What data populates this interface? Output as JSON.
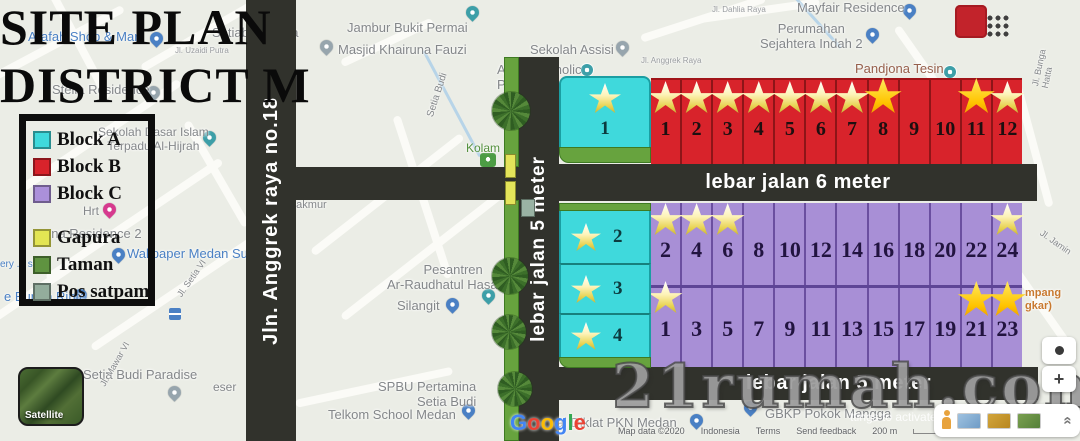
{
  "title": {
    "line1": "SITE PLAN",
    "line2": "DISTRICT M"
  },
  "legend": {
    "items": [
      {
        "label": "Block A",
        "color": "#3fd9dc"
      },
      {
        "label": "Block B",
        "color": "#d8232b"
      },
      {
        "label": "Block C",
        "color": "#ab90da"
      },
      {
        "label": "Gapura",
        "color": "#e3e553"
      },
      {
        "label": "Taman",
        "color": "#5f9340"
      },
      {
        "label": "Pos satpam",
        "color": "#93ad9c"
      }
    ]
  },
  "roads": {
    "street": "Jln. Anggrek raya no.18",
    "entry": "lebar jalan 5 meter",
    "top": "lebar jalan 6 meter",
    "bottom": "lebar jalan 5 meter"
  },
  "site": {
    "block_a": [
      {
        "n": "1",
        "star": "pale"
      },
      {
        "n": "2",
        "star": "pale"
      },
      {
        "n": "3",
        "star": "pale"
      },
      {
        "n": "4",
        "star": "pale"
      }
    ],
    "block_b": [
      {
        "n": "1",
        "star": "pale"
      },
      {
        "n": "2",
        "star": "pale"
      },
      {
        "n": "3",
        "star": "pale"
      },
      {
        "n": "4",
        "star": "pale"
      },
      {
        "n": "5",
        "star": "pale"
      },
      {
        "n": "6",
        "star": "pale"
      },
      {
        "n": "7",
        "star": "pale"
      },
      {
        "n": "8",
        "star": "bright"
      },
      {
        "n": "9"
      },
      {
        "n": "10"
      },
      {
        "n": "11",
        "star": "bright"
      },
      {
        "n": "12",
        "star": "pale"
      }
    ],
    "block_c_even": [
      {
        "n": "2",
        "star": "pale"
      },
      {
        "n": "4",
        "star": "pale"
      },
      {
        "n": "6",
        "star": "pale"
      },
      {
        "n": "8"
      },
      {
        "n": "10"
      },
      {
        "n": "12"
      },
      {
        "n": "14"
      },
      {
        "n": "16"
      },
      {
        "n": "18"
      },
      {
        "n": "20"
      },
      {
        "n": "22"
      },
      {
        "n": "24",
        "star": "pale"
      }
    ],
    "block_c_odd": [
      {
        "n": "1",
        "star": "pale"
      },
      {
        "n": "3"
      },
      {
        "n": "5"
      },
      {
        "n": "7"
      },
      {
        "n": "9"
      },
      {
        "n": "11"
      },
      {
        "n": "13"
      },
      {
        "n": "15"
      },
      {
        "n": "17"
      },
      {
        "n": "19"
      },
      {
        "n": "21",
        "star": "bright"
      },
      {
        "n": "23",
        "star": "bright"
      }
    ]
  },
  "map": {
    "labels": [
      "Jambur Bukit Permai",
      "Setiabudi Vista",
      "Arafah Shop & Mart",
      "Masjid Khairuna Fauzi",
      "Sekolah Assisi",
      "Assisi Catholic\nPr",
      "Jl. Anggrek Raya",
      "Jl. Dahlia Raya",
      "Mayfair Residence",
      "Perumahan\nSejahtera Indah 2",
      "Pandjona Tesin",
      "Stella Residence",
      "Sekolah Dasar Islam\nTerpadu Al-Hijrah",
      "Jl. Uzaidi Putra",
      "Hrt",
      "ena Residence 2",
      "Wallpaper Medan Su",
      "ery ... shop",
      "e Bunga Rinte",
      "Setia Budi Paradise",
      "eser",
      "SPBU Pertamina\nSetia Budi",
      "Telkom School Medan",
      "Balai Diklat PKN Medan",
      "GBKP Pokok Mangga",
      "Kolam",
      "Pesantren\nAr-Raudhatul Hasanah",
      "Silangit",
      "makmur",
      "mpang\ngkar)",
      "Setia Budi",
      "Jl. Setia VI",
      "Jl. Mawar VI",
      "Jl. Bunga Hatta",
      "Jl. Jamin",
      "ttings to activate Wi"
    ],
    "pins": [
      {
        "icon": "pin",
        "tone": "teal"
      },
      {
        "icon": "pin",
        "tone": "gray"
      },
      {
        "icon": "pin",
        "tone": "gray"
      },
      {
        "icon": "dot",
        "tone": "teal"
      },
      {
        "icon": "pin",
        "tone": "blue"
      },
      {
        "icon": "pin",
        "tone": "blue"
      },
      {
        "icon": "dot",
        "tone": "teal"
      },
      {
        "icon": "pin",
        "tone": "gray"
      },
      {
        "icon": "pin",
        "tone": "teal"
      },
      {
        "icon": "pin",
        "tone": "blue"
      },
      {
        "icon": "pin",
        "tone": "pink"
      },
      {
        "icon": "pin",
        "tone": "blue"
      },
      {
        "icon": "pin",
        "tone": "blue"
      },
      {
        "icon": "pin",
        "tone": "gray"
      },
      {
        "icon": "pin",
        "tone": "blue"
      },
      {
        "icon": "pin",
        "tone": "blue"
      },
      {
        "icon": "pin",
        "tone": "blue"
      },
      {
        "icon": "pin",
        "tone": "teal"
      },
      {
        "icon": "pin",
        "tone": "blue"
      },
      {
        "icon": "park",
        "tone": "green"
      },
      {
        "icon": "transit",
        "tone": "blue"
      }
    ]
  },
  "colors": {
    "tones": {
      "blue": "#4a80c4",
      "teal": "#3d9fa8",
      "gray": "#97a5ad",
      "pink": "#d63a8e",
      "green": "#4c9c44"
    },
    "google_letters": [
      "#4285F4",
      "#EA4335",
      "#FBBC05",
      "#4285F4",
      "#34A853",
      "#EA4335"
    ]
  },
  "watermark": "21rumah.com",
  "footer": {
    "google": "Google",
    "satellite_label": "Satellite",
    "attribution": [
      "Map data ©2020",
      "Indonesia",
      "Terms",
      "Send feedback",
      "200 m"
    ]
  },
  "ui": {
    "zoom_in": "+",
    "collapse": "«"
  }
}
